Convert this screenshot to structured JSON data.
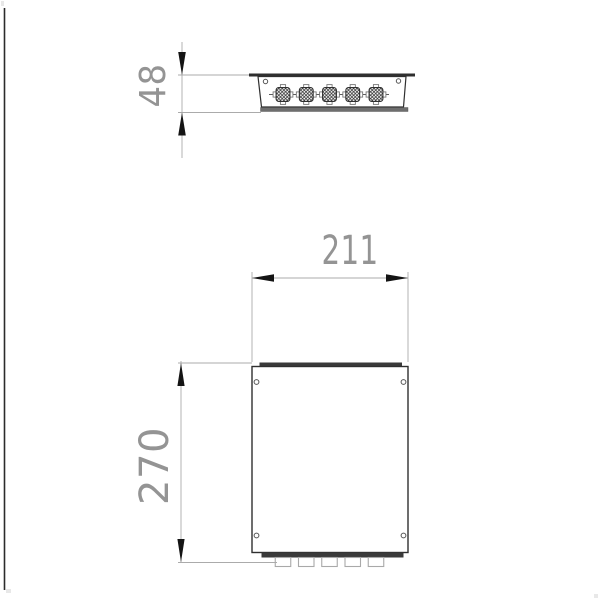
{
  "page": {
    "background": "#ffffff"
  },
  "drawing": {
    "dimension_labels": {
      "depth": "48",
      "width": "211",
      "height": "270"
    },
    "top_view": {
      "cable_gland_count": 5,
      "screw_count": 2
    },
    "front_view": {
      "screw_count": 4,
      "bottom_connector_count": 5
    },
    "colors": {
      "outline": "#2f2f2f",
      "bar_fill": "#3a3a3a",
      "lip_fill": "#6e6e6e",
      "dim_line": "#ababab",
      "dim_text": "#949494",
      "arrow": "#141414",
      "light_detail": "#a9a9a9",
      "edge_line": "#2b2b2b"
    }
  }
}
